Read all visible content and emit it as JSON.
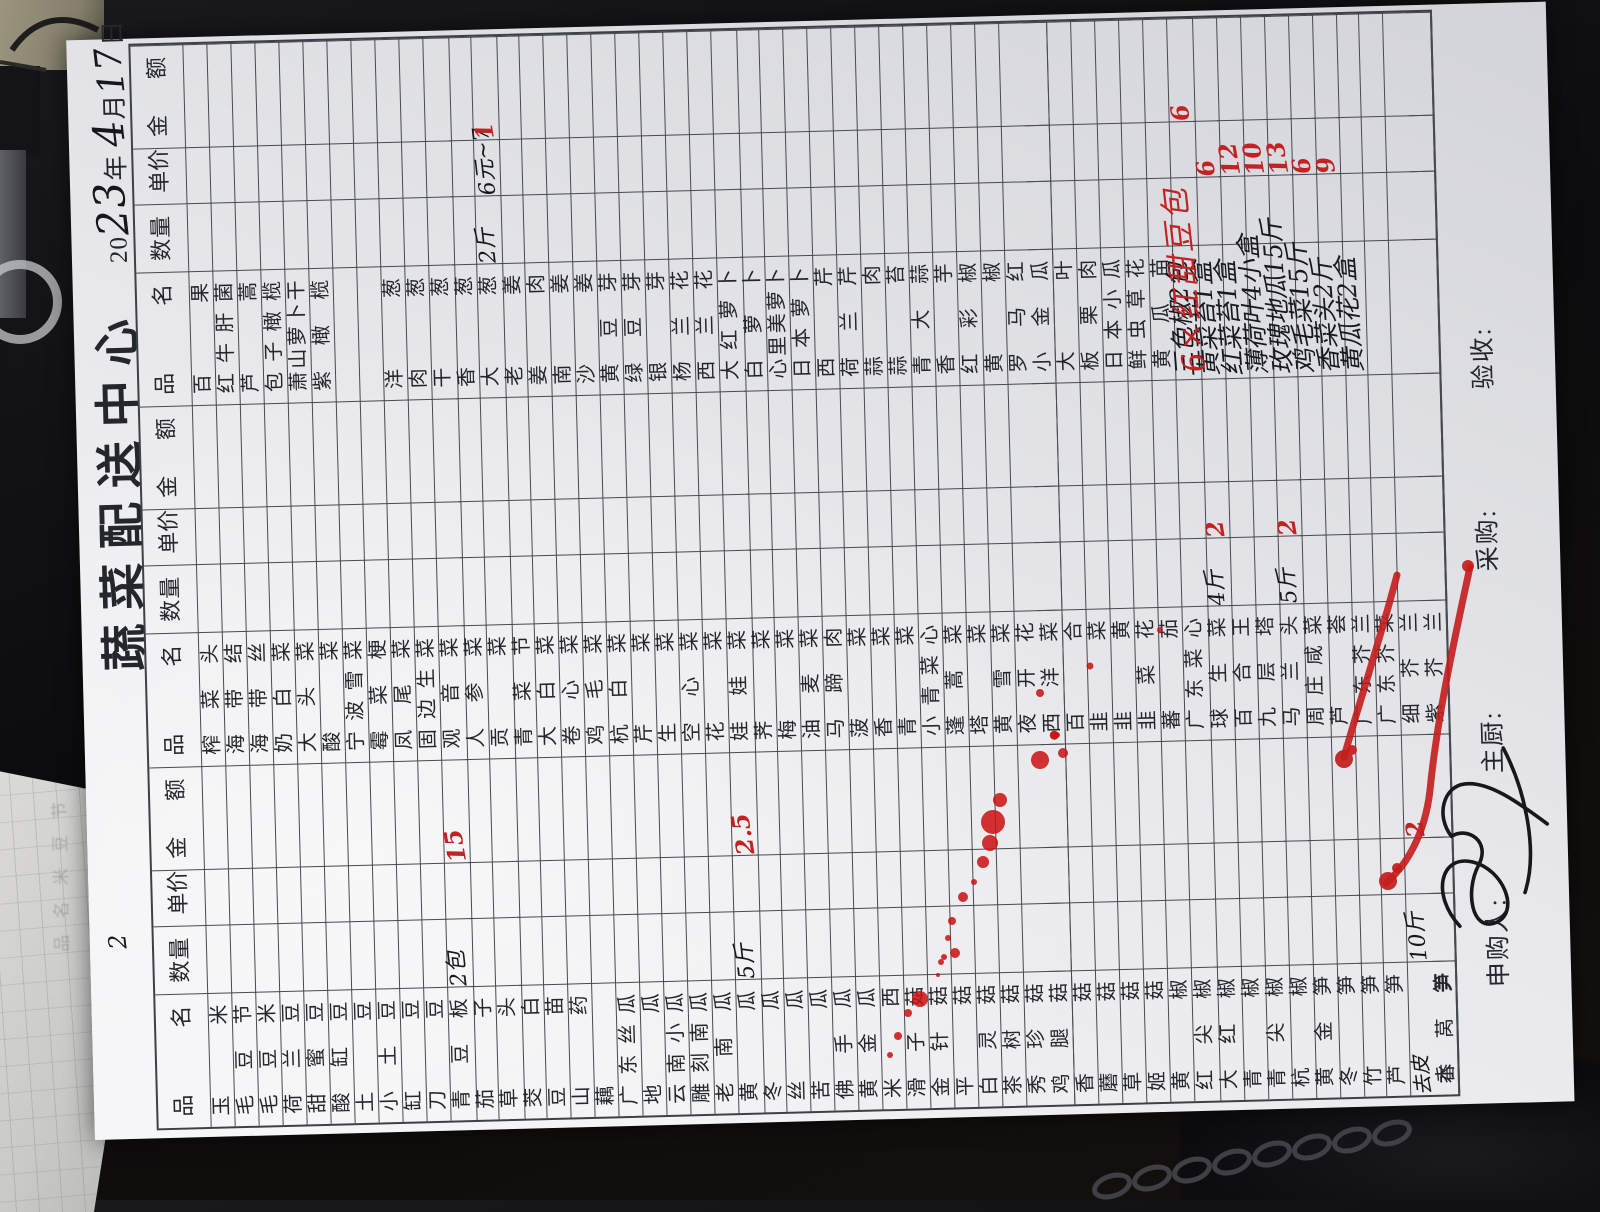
{
  "title": "蔬菜配送中心",
  "date": {
    "prefix": "20",
    "year_hw": "23",
    "year_label": "年",
    "month_hw": "4",
    "month_label": "月",
    "day_hw": "17",
    "day_label": "日"
  },
  "table": {
    "headers": {
      "name": "品 名",
      "qty": "数量",
      "price": "单价",
      "amount": "金 额"
    },
    "rows": [
      {
        "n1": "玉米",
        "n2": "榨菜头",
        "n3": "百果"
      },
      {
        "n1": "毛豆节",
        "n2": "海带结",
        "n3": "红牛肝菌"
      },
      {
        "n1": "毛豆米",
        "n2": "海带丝",
        "n3": "芦蒿"
      },
      {
        "n1": "荷兰豆",
        "n2": "奶白菜",
        "n3": "包子橄榄"
      },
      {
        "n1": "甜蜜豆",
        "n2": "大头菜",
        "n3": "萧山萝卜干"
      },
      {
        "n1": "酸缸豆",
        "n2": "酸菜",
        "n3": "紫橄榄"
      },
      {
        "n1": "土豆",
        "n2": "宁波雪菜",
        "n3": ""
      },
      {
        "n1": "小土豆",
        "n2": "霉菜梗",
        "n3": ""
      },
      {
        "n1": "缸豆",
        "n2": "凤尾菜",
        "n3": "洋葱"
      },
      {
        "n1": "刀豆",
        "n2": "固边生菜",
        "n3": "肉葱"
      },
      {
        "n1": "青豆板",
        "q1": "2包",
        "ra1": "15",
        "n2": "观音菜",
        "n3": "干葱"
      },
      {
        "n1": "茄子",
        "n2": "人参菜",
        "n3": "香葱"
      },
      {
        "n1": "草头",
        "n2": "贡菜",
        "n3": "大葱",
        "q3": "2斤",
        "p3": "6元~7",
        "ra3": "1"
      },
      {
        "n1": "茭白",
        "n2": "青菜节",
        "n3": "老姜"
      },
      {
        "n1": "豆苗",
        "n2": "大白菜",
        "n3": "姜肉"
      },
      {
        "n1": "山药",
        "n2": "卷心菜",
        "n3": "南姜"
      },
      {
        "n1": "藕",
        "n2": "鸡毛菜",
        "n3": "沙姜"
      },
      {
        "n1": "广东丝瓜",
        "n2": "杭白菜",
        "n3": "黄豆芽"
      },
      {
        "n1": "地瓜",
        "n2": "芹菜",
        "n3": "绿豆芽"
      },
      {
        "n1": "云南小瓜",
        "n2": "生菜",
        "n3": "银芽"
      },
      {
        "n1": "雕刻南瓜",
        "n2": "空心菜",
        "n3": "杨兰花"
      },
      {
        "n1": "老南瓜",
        "n2": "花菜",
        "n3": "西兰花"
      },
      {
        "n1": "黄瓜",
        "q1": "5斤",
        "ra1": "2.5",
        "n2": "娃娃菜",
        "n3": "大红萝卜"
      },
      {
        "n1": "冬瓜",
        "n2": "荠菜",
        "n3": "白萝卜"
      },
      {
        "n1": "丝瓜",
        "n2": "梅菜",
        "n3": "心里美萝卜"
      },
      {
        "n1": "苦瓜",
        "n2": "油麦菜",
        "n3": "日本萝卜"
      },
      {
        "n1": "佛手瓜",
        "n2": "马蹄肉",
        "n3": "西芹"
      },
      {
        "n1": "黄金瓜",
        "n2": "菠菜",
        "n3": "荷兰芹"
      },
      {
        "n1": "米西",
        "n2": "香菜",
        "n3": "蒜肉"
      },
      {
        "n1": "滑子菇",
        "n2": "青菜",
        "n3": "蒜苔"
      },
      {
        "n1": "金针菇",
        "n2": "小青菜心",
        "n3": "青大蒜"
      },
      {
        "n1": "平菇",
        "n2": "蓬蒿菜",
        "n3": "香芋"
      },
      {
        "n1": "白灵菇",
        "n2": "塔菜",
        "n3": "红彩椒"
      },
      {
        "n1": "茶树菇",
        "n2": "黄雪菜",
        "n3": "黄椒"
      },
      {
        "n1": "秀珍菇",
        "n2": "夜开花",
        "dot2": true,
        "n3": "罗马红"
      },
      {
        "n1": "鸡腿菇",
        "n2": "西洋菜",
        "n3": "小金瓜"
      },
      {
        "n1": "香菇",
        "n2": "百合",
        "n3": "大叶"
      },
      {
        "n1": "蘑菇",
        "n2": "韭菜",
        "n3": "板栗肉"
      },
      {
        "n1": "草菇",
        "n2": "韭黄",
        "n3": "日本小瓜"
      },
      {
        "n1": "姬菇",
        "n2": "韭菜花",
        "n3": "鲜虫草花"
      },
      {
        "n1": "黄椒",
        "n2": "蕃茄",
        "n3": "黄瓜苗"
      },
      {
        "n1": "红尖椒",
        "n2": "广东菜心",
        "n3": "三色椒2包",
        "hw3": true,
        "ra3": "6"
      },
      {
        "n1": "大红椒",
        "n2": "球生菜",
        "q2": "4斤",
        "rp2": "2",
        "n3": "黄菜苔1盒",
        "hw3": true,
        "rp3": "6"
      },
      {
        "n1": "青椒",
        "n2": "百合王",
        "n3": "红菜苔1盒",
        "hw3": true,
        "rp3": "12"
      },
      {
        "n1": "青尖椒",
        "n2": "九层塔",
        "n3": "薄荷叶4小盒",
        "hw3": true,
        "rp3": "10"
      },
      {
        "n1": "杭椒",
        "n2": "马兰头",
        "q2": "5斤",
        "rp2": "2",
        "n3": "玫瑰地瓜15斤",
        "hw3": true,
        "rp3": "13"
      },
      {
        "n1": "黄金笋",
        "n2": "周庄咸菜",
        "n3": "鸡毛菜15斤",
        "hw3": true,
        "rp3": "6"
      },
      {
        "n1": "冬笋",
        "n2": "芦荟",
        "n3": "香菜头2斤",
        "hw3": true,
        "rp3": "9"
      },
      {
        "n1": "竹笋",
        "n2": "广东芥兰",
        "n3": "黄瓜花2盒",
        "hw3": true
      },
      {
        "n1": "芦笋",
        "n2": "广东芥菜",
        "n3": ""
      },
      {
        "n1": "香莴笋",
        "pre1": "去皮",
        "q1": "10斤",
        "ra1": "2",
        "n2": "细芥兰",
        "n3": ""
      },
      {
        "n1": "水笋",
        "n2": "紫芥兰",
        "n3": ""
      }
    ]
  },
  "footer": {
    "requester_label": "申购人:",
    "chef_label": "主厨:",
    "purchaser_label": "采购:",
    "inspector_label": "验收:"
  },
  "annotations": {
    "red_overlay_text": "6×红甜豆包",
    "stray_mark": "2"
  },
  "background": {
    "under_sheet_faint_text": "品 名 米 豆 节"
  },
  "colors": {
    "red_ink": "#c32222",
    "black_ink": "#15171c",
    "printed_text": "#23262c",
    "paper": "#e9e9ec",
    "grid_line": "#464a52",
    "desk": "#0c0c0e"
  }
}
